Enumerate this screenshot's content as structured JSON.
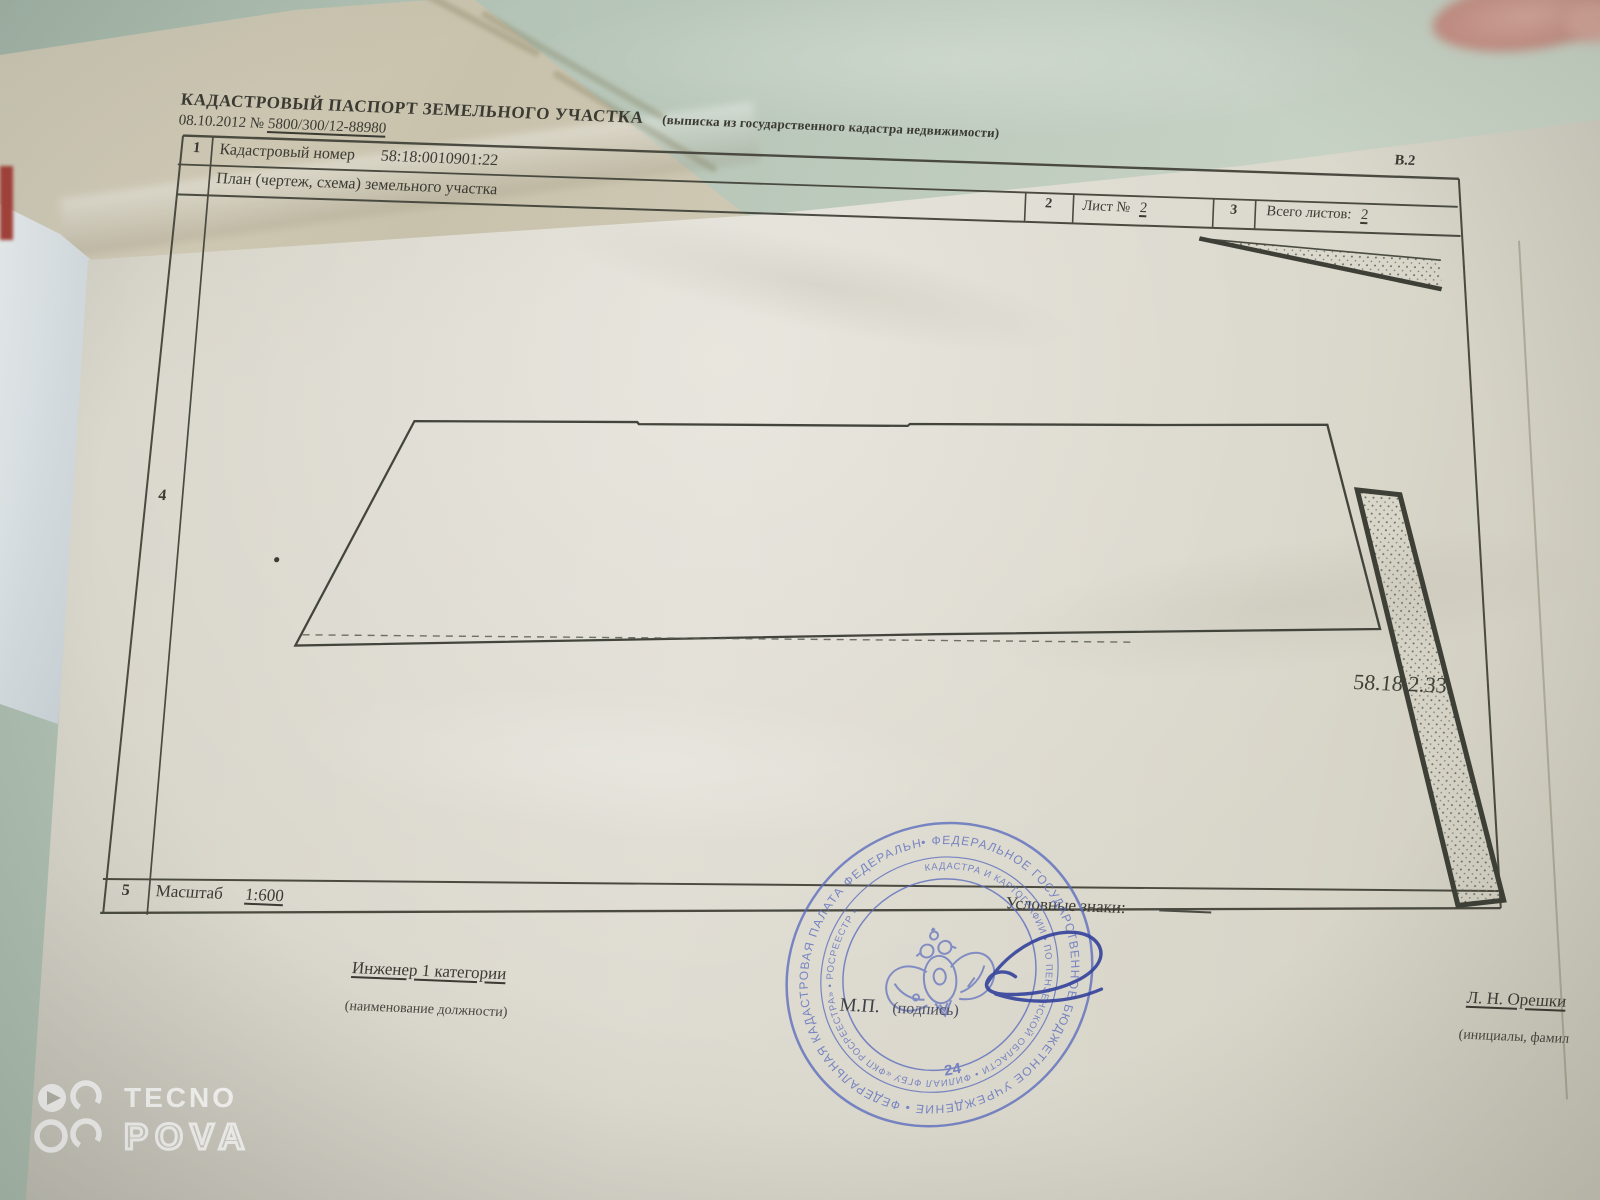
{
  "watermark": {
    "brand": "TECNO",
    "model": "POVA"
  },
  "document": {
    "form_code": "В.2",
    "header": {
      "title": "КАДАСТРОВЫЙ ПАСПОРТ ЗЕМЕЛЬНОГО УЧАСТКА",
      "subtitle": "(выписка из государственного кадастра недвижимости)",
      "date_prefix": "08.10.2012 №",
      "doc_number": "5800/300/12-88980"
    },
    "table": {
      "row1_num": "1",
      "cadastral_number_label": "Кадастровый номер",
      "cadastral_number_value": "58:18:0010901:22",
      "plan_title": "План (чертеж, схема) земельного участка",
      "col2_num": "2",
      "sheet_label": "Лист №",
      "sheet_value": "2",
      "col3_num": "3",
      "total_sheets_label": "Всего листов:",
      "total_sheets_value": "2",
      "row4_num": "4",
      "parcel_label": "58.18.2.33",
      "row5_num": "5",
      "scale_label": "Масштаб",
      "scale_value": "1:600",
      "legend_label": "Условные знаки:"
    },
    "signature_block": {
      "position": "Инженер 1 категории",
      "position_caption": "(наименование должности)",
      "mp_label": "М.П.",
      "signature_caption": "(подпись)",
      "name": "Л. Н. Орешки",
      "name_caption": "(инициалы, фамил"
    },
    "stamp": {
      "outer_ring": "• ФЕДЕРАЛЬНОЕ ГОСУДАРСТВЕННОЕ БЮДЖЕТНОЕ УЧРЕЖДЕНИЕ • ФЕДЕРАЛЬНАЯ КАДАСТРОВАЯ ПАЛАТА ФЕДЕРАЛЬНОЙ СЛУЖБЫ ГОСУДАРСТВЕННОЙ РЕГИСТРАЦИИ,",
      "inner_ring": "КАДАСТРА И КАРТОГРАФИИ • ПО ПЕНЗЕНСКОЙ ОБЛАСТИ • ФИЛИАЛ ФГБУ «ФКП РОСРЕЕСТРА» • РОСРЕЕСТР •",
      "number": "24",
      "color": "#5b6cbe"
    }
  }
}
